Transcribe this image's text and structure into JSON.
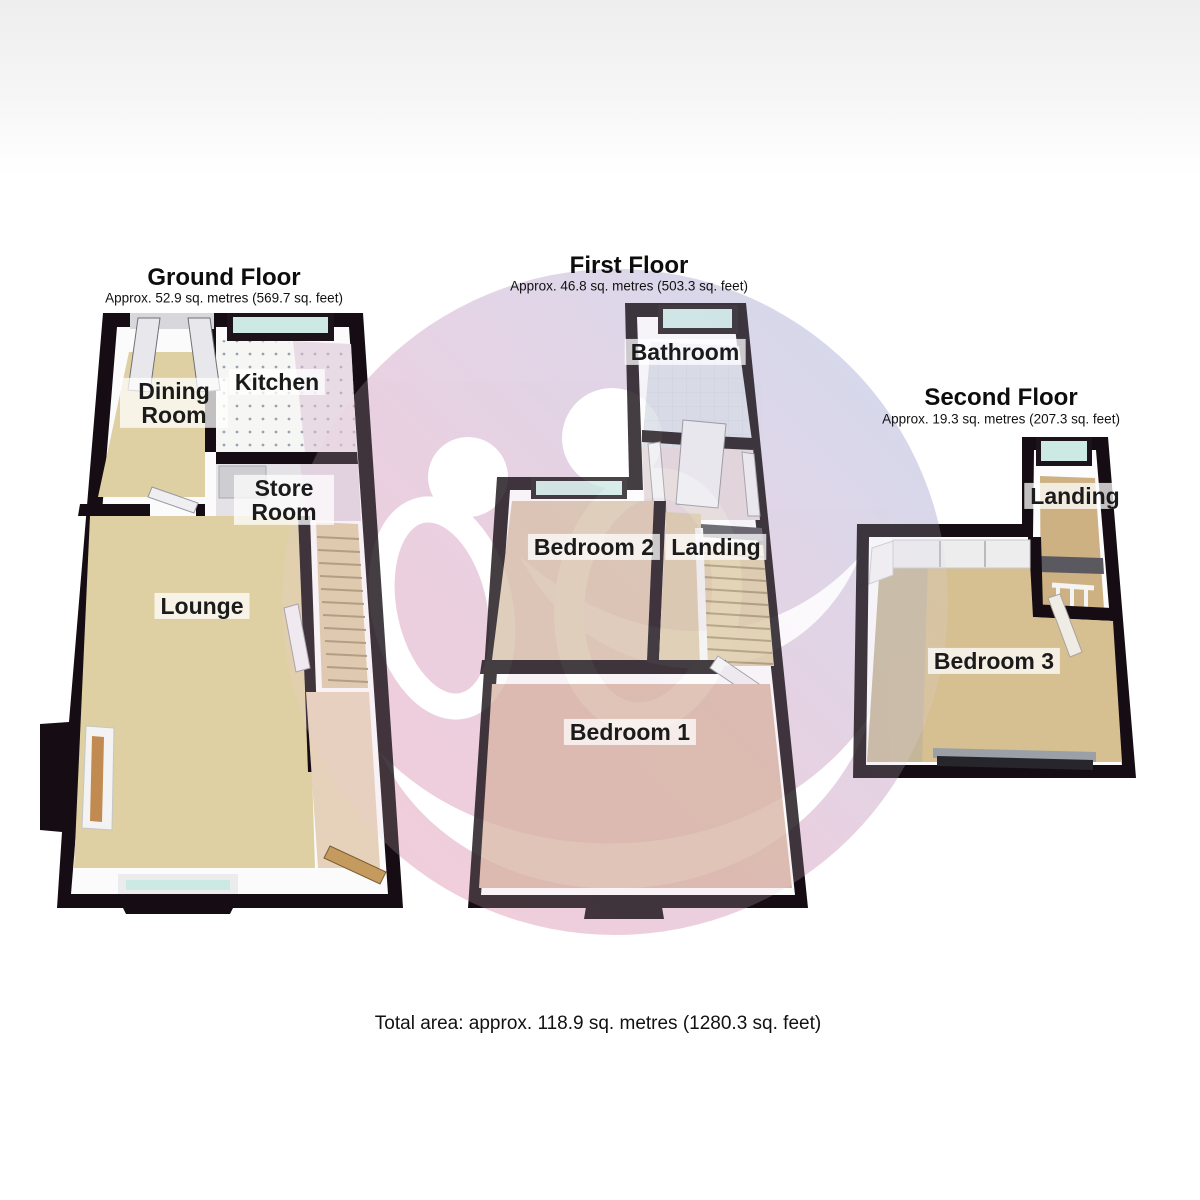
{
  "floors": {
    "ground": {
      "title": "Ground Floor",
      "area": "Approx. 52.9 sq. metres (569.7 sq. feet)",
      "rooms": {
        "dining": "Dining Room",
        "kitchen": "Kitchen",
        "store": "Store Room",
        "lounge": "Lounge"
      }
    },
    "first": {
      "title": "First Floor",
      "area": "Approx. 46.8 sq. metres (503.3 sq. feet)",
      "rooms": {
        "bathroom": "Bathroom",
        "bedroom2": "Bedroom 2",
        "landing": "Landing",
        "bedroom1": "Bedroom 1"
      }
    },
    "second": {
      "title": "Second Floor",
      "area": "Approx. 19.3 sq. metres (207.3 sq. feet)",
      "rooms": {
        "landing": "Landing",
        "bedroom3": "Bedroom 3"
      }
    }
  },
  "footer": {
    "total_area": "Total area: approx. 118.9 sq. metres (1280.3 sq. feet)"
  },
  "colors": {
    "wall": "#150d13",
    "floor_beige": "#ded0a2",
    "floor_salmon": "#d9b6a6",
    "floor_tile": "#d7dce5",
    "window_glass": "#cde9e4",
    "watermark_pink": "#f2c9d7",
    "watermark_lavender": "#ddd5e8",
    "watermark_blue": "#ccd7ec"
  }
}
